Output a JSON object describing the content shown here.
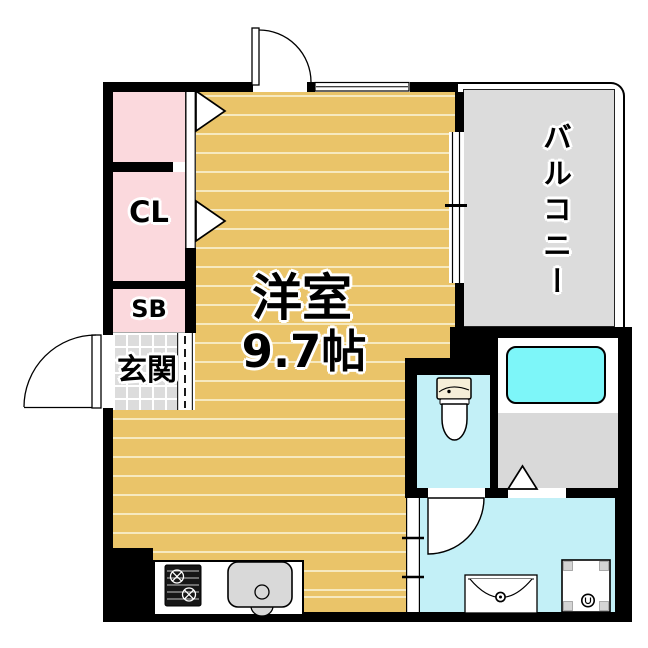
{
  "title": "apartment-floor-plan",
  "rooms": {
    "main": {
      "label": "洋室",
      "size": "9.7帖"
    },
    "balcony": {
      "label": "バルコニー"
    },
    "closet": {
      "label": "CL"
    },
    "shoe_box": {
      "label": "SB"
    },
    "entrance": {
      "label": "玄関"
    }
  },
  "fixtures": [
    "toilet",
    "bathtub",
    "washbasin",
    "washing-machine-pan",
    "gas-stove",
    "kitchen-sink"
  ],
  "colors": {
    "wall": "#000000",
    "flooring": "#eac469",
    "flooring_stripe": "#f6e9c0",
    "closet_pink": "#fbd9dd",
    "tile_gray": "#dcdcdc",
    "tile_grout": "#ffffff",
    "wet_cyan": "#c3f0f7",
    "tub_cyan": "#7df6f9",
    "bath_floor": "#d9d9d9",
    "tank_beige": "#f6efd9",
    "sink_gray": "#d9d9d9",
    "pan_corner": "#d4d4d4",
    "stove_black": "#161616"
  }
}
